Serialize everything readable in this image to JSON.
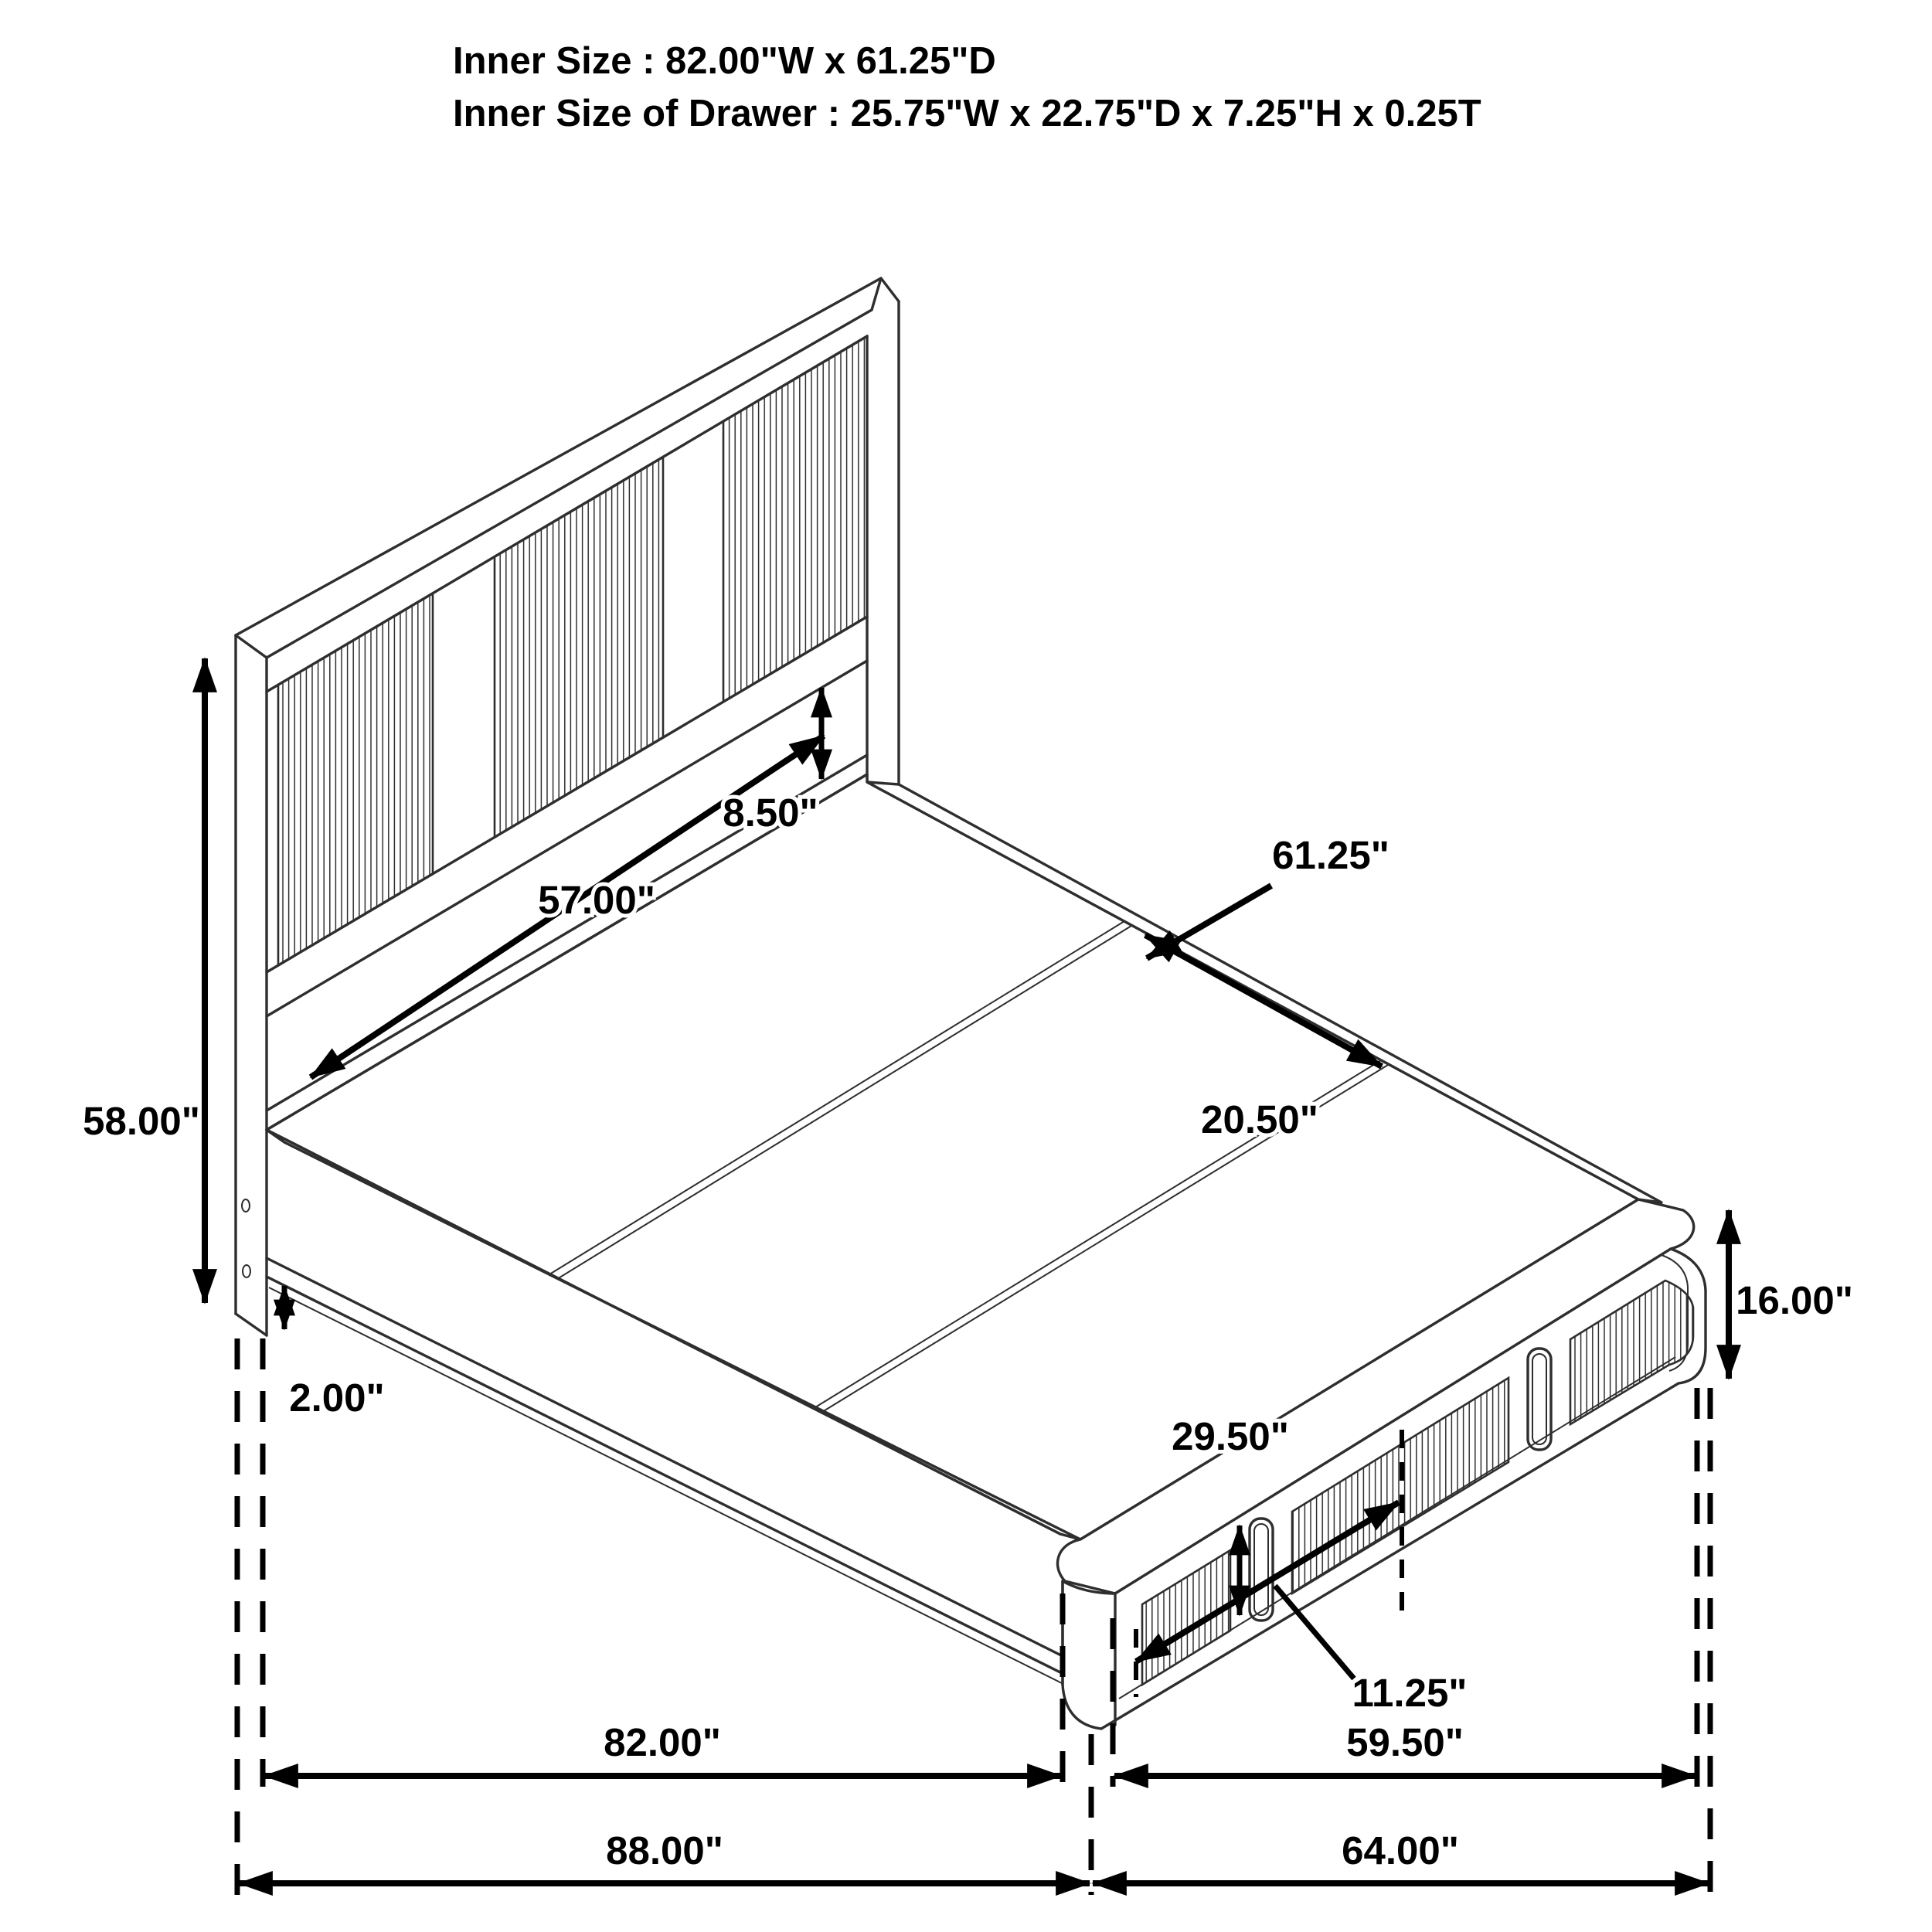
{
  "header": {
    "line1": "Inner Size : 82.00\"W x 61.25\"D",
    "line2": "Inner Size of Drawer : 25.75\"W x 22.75\"D x 7.25\"H x 0.25T"
  },
  "dimensions": {
    "headboard_height": "58.00\"",
    "headboard_opening_width": "57.00\"",
    "headboard_opening_height": "8.50\"",
    "platform_depth": "61.25\"",
    "deck_board_depth": "20.50\"",
    "floor_clearance": "2.00\"",
    "footboard_height": "16.00\"",
    "drawer_front_width": "29.50\"",
    "drawer_front_height": "11.25\"",
    "inner_length": "82.00\"",
    "footboard_front_width": "59.50\"",
    "outer_length": "88.00\"",
    "outer_width": "64.00\""
  },
  "colors": {
    "line_art": "#2e2e2e",
    "dimension": "#000000",
    "background": "#ffffff"
  }
}
